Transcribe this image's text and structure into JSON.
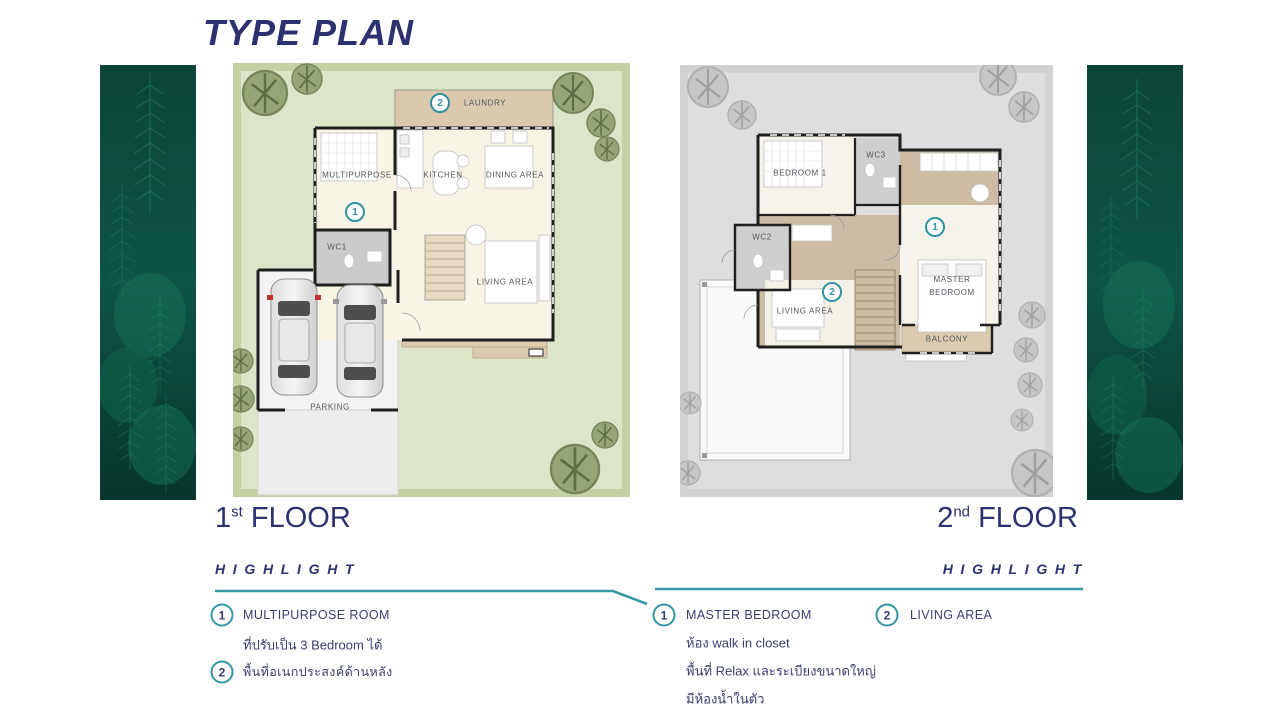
{
  "title": "TYPE PLAN",
  "colors": {
    "navy": "#2e3170",
    "teal": "#3898a8"
  },
  "floor1": {
    "label_num": "1",
    "label_sup": "st",
    "label_word": "FLOOR",
    "rooms": {
      "laundry": "LAUNDRY",
      "multipurpose": "MULTIPURPOSE",
      "kitchen": "KITCHEN",
      "dining": "DINING AREA",
      "wc1": "WC1",
      "living": "LIVING AREA",
      "parking": "PARKING"
    },
    "markers": {
      "laundry": "2",
      "multipurpose": "1"
    },
    "highlight": {
      "heading": "HIGHLIGHT",
      "items": [
        {
          "num": "1",
          "title": "MULTIPURPOSE ROOM",
          "lines": [
            "ที่ปรับเป็น 3 Bedroom ได้"
          ]
        },
        {
          "num": "2",
          "title": "พื้นที่อเนกประสงค์ด้านหลัง",
          "lines": []
        }
      ]
    }
  },
  "floor2": {
    "label_num": "2",
    "label_sup": "nd",
    "label_word": "FLOOR",
    "rooms": {
      "bedroom1": "BEDROOM 1",
      "wc3": "WC3",
      "wc2": "WC2",
      "living": "LIVING AREA",
      "master": "MASTER BEDROOM",
      "balcony": "BALCONY"
    },
    "markers": {
      "master": "1",
      "living": "2"
    },
    "highlight": {
      "heading": "HIGHLIGHT",
      "items": [
        {
          "num": "1",
          "title": "MASTER BEDROOM",
          "lines": [
            "ห้อง walk in closet",
            "พื้นที่ Relax และระเบียงขนาดใหญ่",
            "มีห้องน้ำในตัว"
          ]
        },
        {
          "num": "2",
          "title": "LIVING AREA",
          "lines": []
        }
      ]
    }
  }
}
